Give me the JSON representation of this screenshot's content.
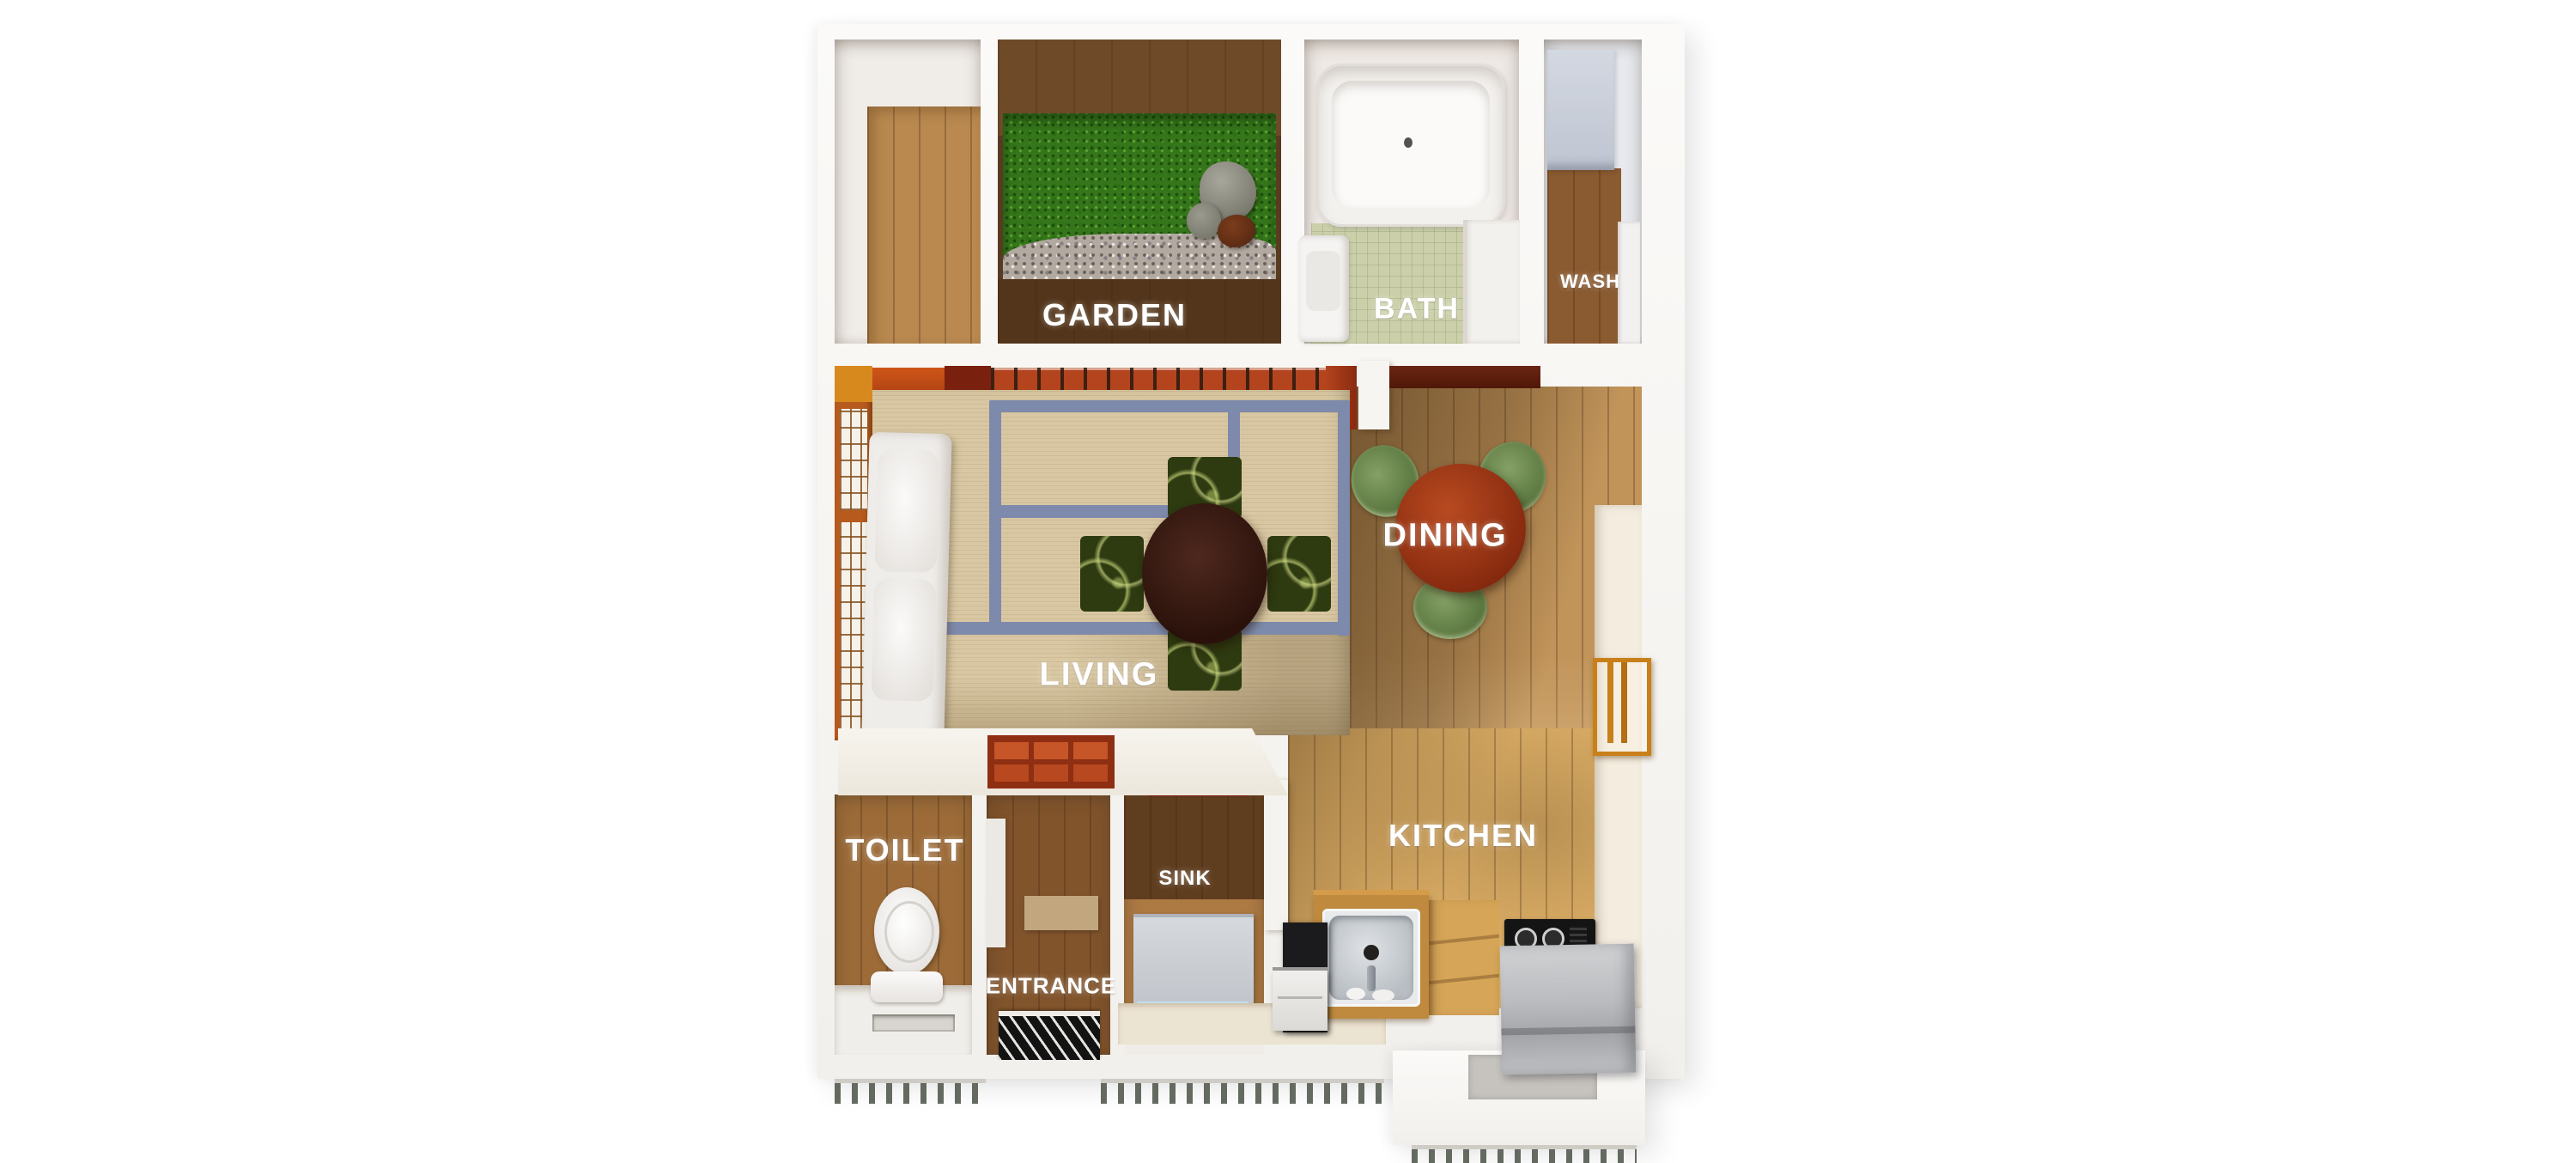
{
  "image_type": "3d-rendered apartment floor plan, top-down view",
  "rooms": {
    "garden": {
      "label": "GARDEN"
    },
    "bath": {
      "label": "BATH"
    },
    "wash": {
      "label": "WASH"
    },
    "living": {
      "label": "LIVING"
    },
    "dining": {
      "label": "DINING"
    },
    "toilet": {
      "label": "TOILET"
    },
    "entrance": {
      "label": "ENTRANCE"
    },
    "sink": {
      "label": "SINK"
    },
    "kitchen": {
      "label": "KITCHEN"
    }
  },
  "palette": {
    "background": "#ffffff",
    "wall_white": "#f6f4f0",
    "wood_light": "#e0b268",
    "wood_mid": "#b9894f",
    "wood_dark": "#6e4a28",
    "deck_dark": "#53351b",
    "grass_green": "#35761a",
    "gravel_gray": "#b2a9a0",
    "tatami_beige": "#d8c7a2",
    "tatami_border_blue": "#7e8aab",
    "shoji_orange": "#b75a1e",
    "accent_red": "#b3441d",
    "beam_maroon": "#7e1a0c",
    "table_dark_brown": "#2a120b",
    "cushion_green": "#2e3a10",
    "dining_table_red": "#8a2c10",
    "chair_green": "#5d7a42",
    "bath_floor_green": "#cbd0aa",
    "appliance_gray": "#c6ccd6",
    "washer_front_blue": "#9fc9d8",
    "steel_gray": "#c6cbd0",
    "stove_black": "#141414",
    "fridge_gray": "#b4b6b9",
    "counter_cream": "#ece4d2",
    "label_text": "#ffffff"
  }
}
